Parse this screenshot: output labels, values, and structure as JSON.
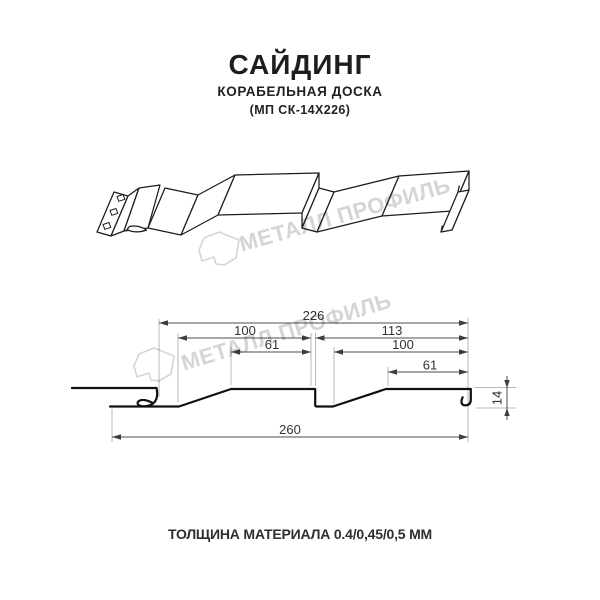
{
  "header": {
    "title": "САЙДИНГ",
    "subtitle": "КОРАБЕЛЬНАЯ ДОСКА",
    "model": "(МП СК-14Х226)"
  },
  "watermark": {
    "brand_text": "МЕТАЛЛ ПРОФИЛЬ",
    "logo": "metall-profil-house-logo",
    "color": "#d5d5d5"
  },
  "technical_drawing": {
    "dimensions": {
      "module_width": "226",
      "left_flat_width": "100",
      "left_top_width": "61",
      "right_span": "113",
      "right_flat_width": "100",
      "right_top_width": "61",
      "overall_width": "260",
      "profile_height": "14"
    }
  },
  "footer": {
    "thickness_label": "ТОЛЩИНА МАТЕРИАЛА 0.4/0,45/0,5 ММ"
  },
  "colors": {
    "profile_line": "#101010",
    "dimension_line": "#4d4d4d",
    "extension_line": "#b9b9b9",
    "text": "#1e1e1e",
    "watermark": "#d5d5d5",
    "background": "#ffffff"
  }
}
